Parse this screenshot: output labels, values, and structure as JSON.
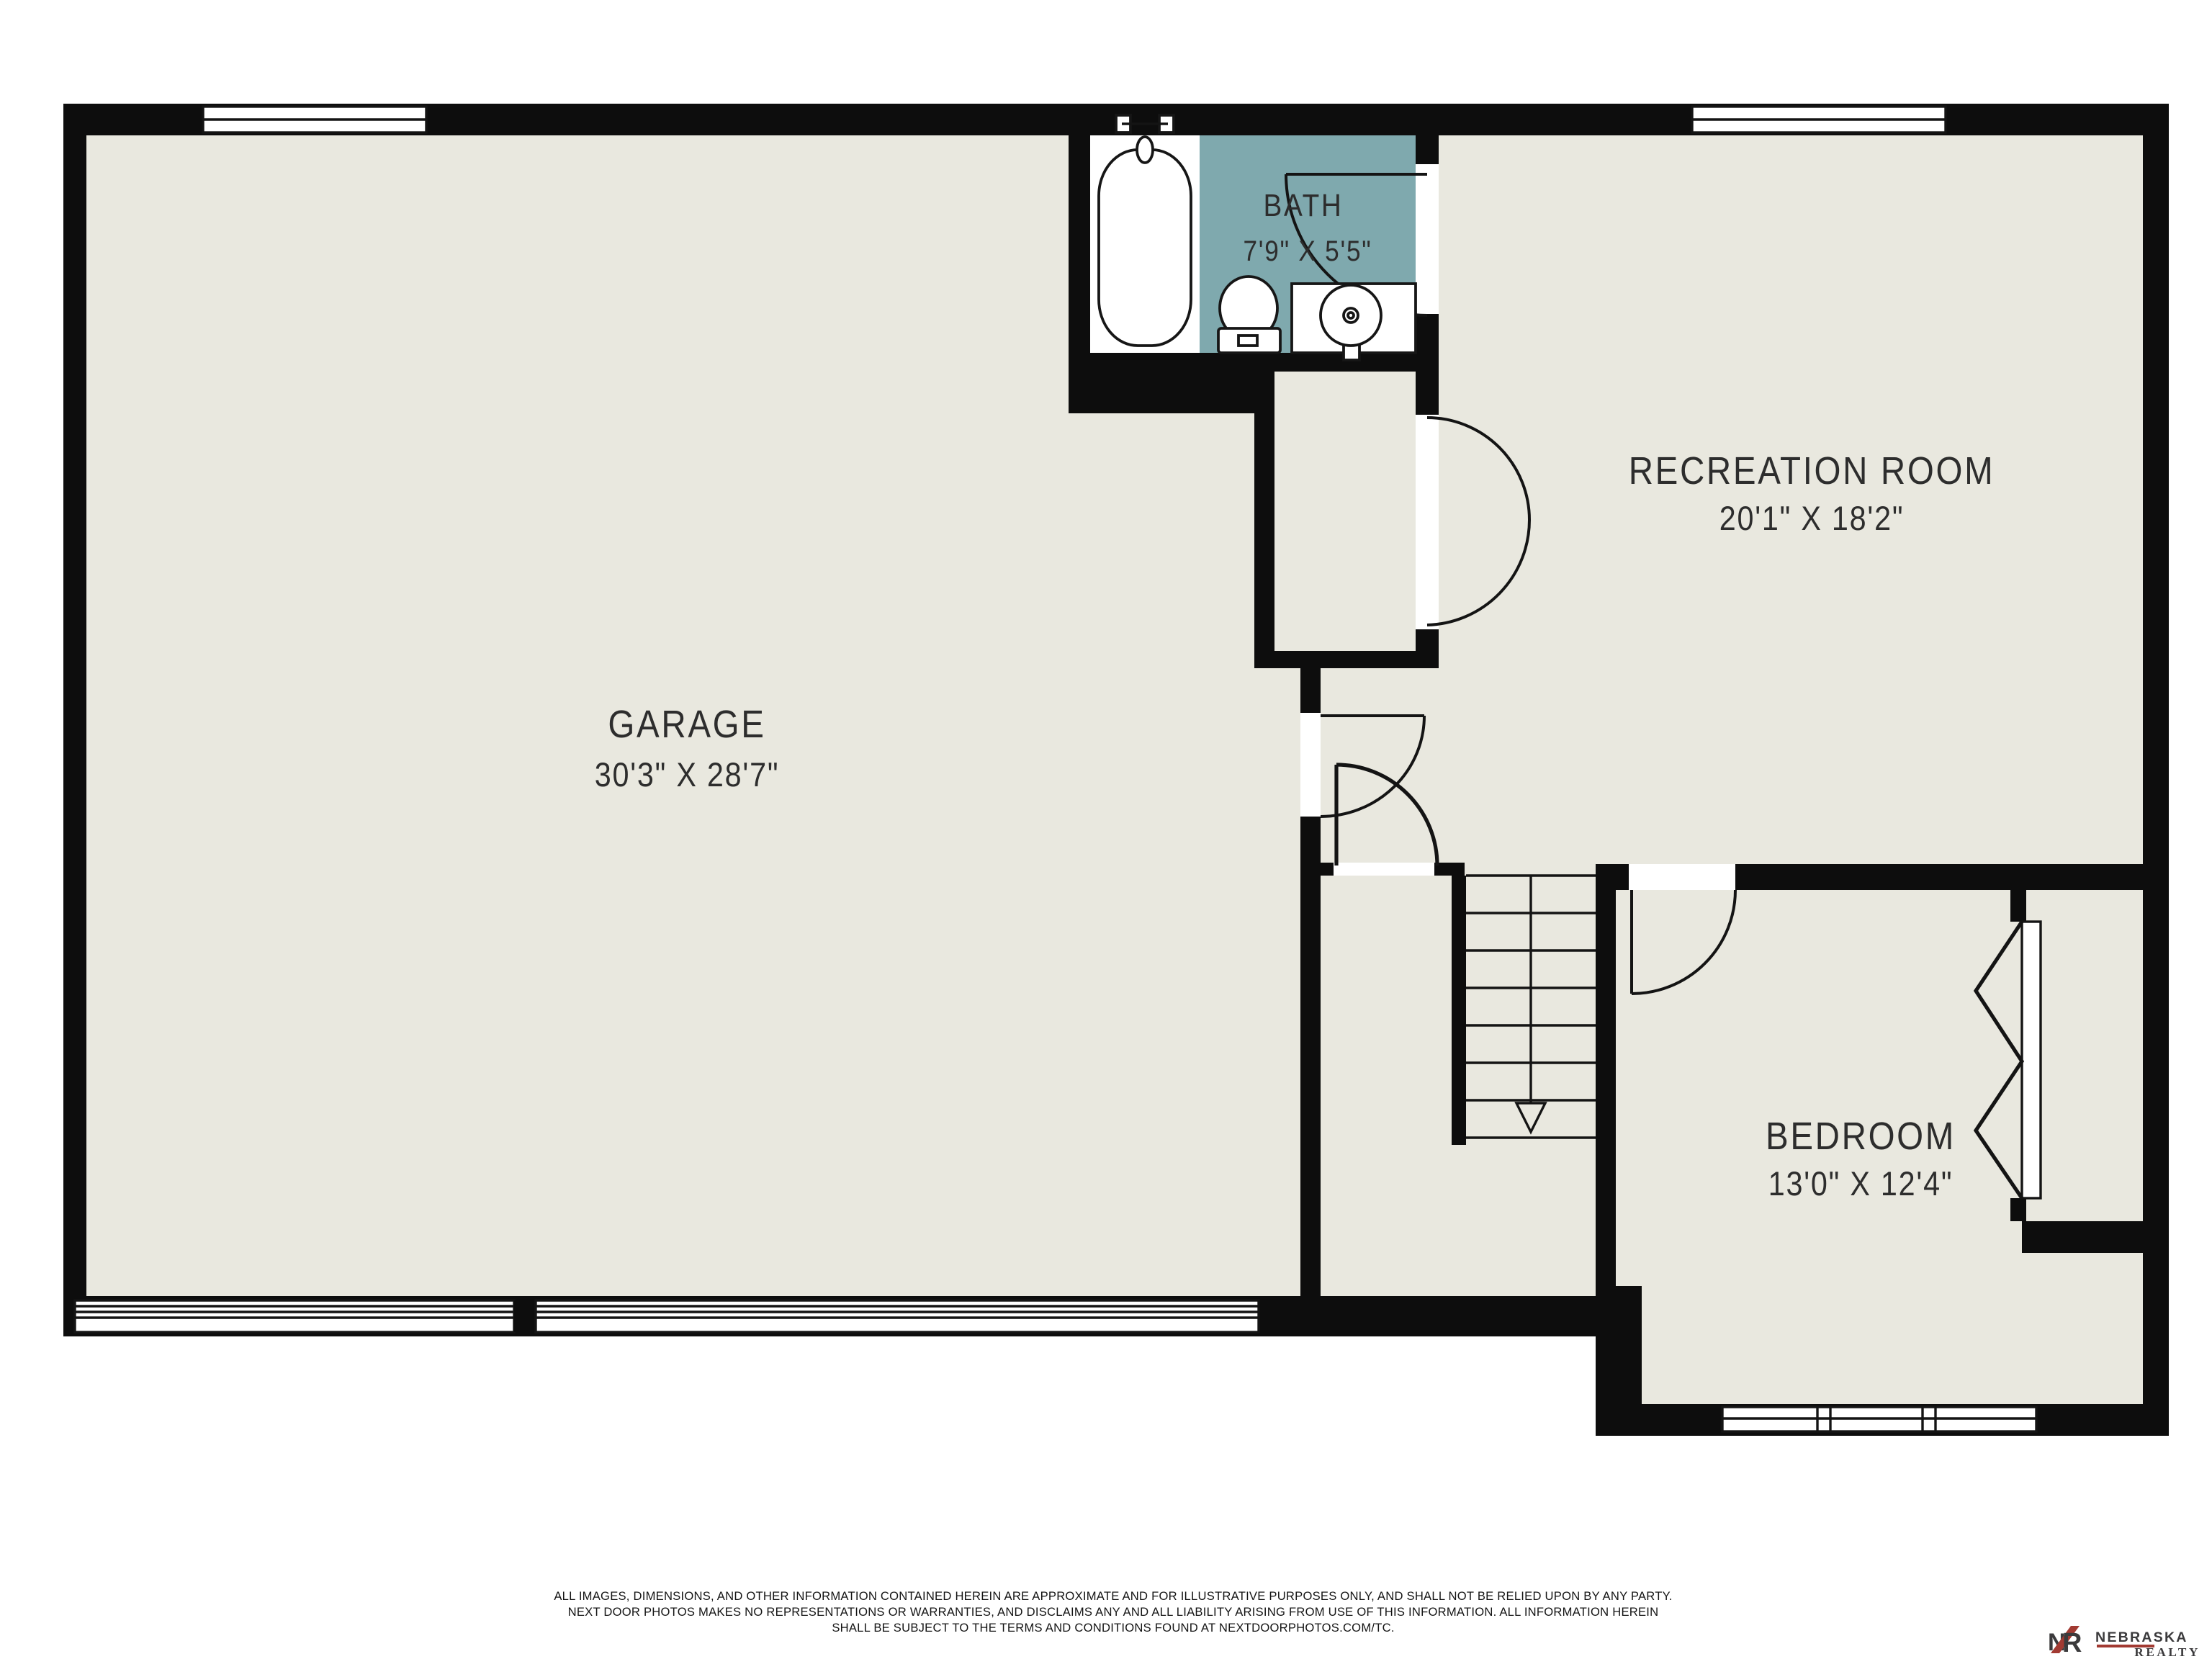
{
  "plan": {
    "rooms": [
      {
        "id": "garage",
        "label": "GARAGE",
        "dimensions": "30'3\" X 28'7\""
      },
      {
        "id": "bath",
        "label": "BATH",
        "dimensions": "7'9\" X 5'5\""
      },
      {
        "id": "recreation-room",
        "label": "RECREATION ROOM",
        "dimensions": "20'1\" X 18'2\""
      },
      {
        "id": "bedroom",
        "label": "BEDROOM",
        "dimensions": "13'0\" X 12'4\""
      }
    ]
  },
  "disclaimer": {
    "line1": "ALL IMAGES, DIMENSIONS, AND OTHER INFORMATION CONTAINED HEREIN ARE APPROXIMATE AND FOR ILLUSTRATIVE PURPOSES ONLY, AND SHALL NOT BE RELIED UPON BY ANY PARTY.",
    "line2": "NEXT DOOR PHOTOS MAKES NO REPRESENTATIONS OR WARRANTIES, AND DISCLAIMS ANY AND ALL LIABILITY ARISING FROM USE OF THIS INFORMATION. ALL INFORMATION HEREIN",
    "line3": "SHALL BE SUBJECT TO THE TERMS AND CONDITIONS FOUND AT NEXTDOORPHOTOS.COM/TC."
  },
  "branding": {
    "monogram_n": "N",
    "monogram_r": "R",
    "name": "NEBRASKA",
    "subtitle": "REALTY"
  },
  "colors": {
    "background": "#ffffff",
    "wall": "#0d0d0d",
    "floor": "#e9e8df",
    "bath_floor": "#7fa9ae",
    "text": "#2d2d2d",
    "logo_dark": "#3b3a3c",
    "logo_red": "#a23a32"
  }
}
